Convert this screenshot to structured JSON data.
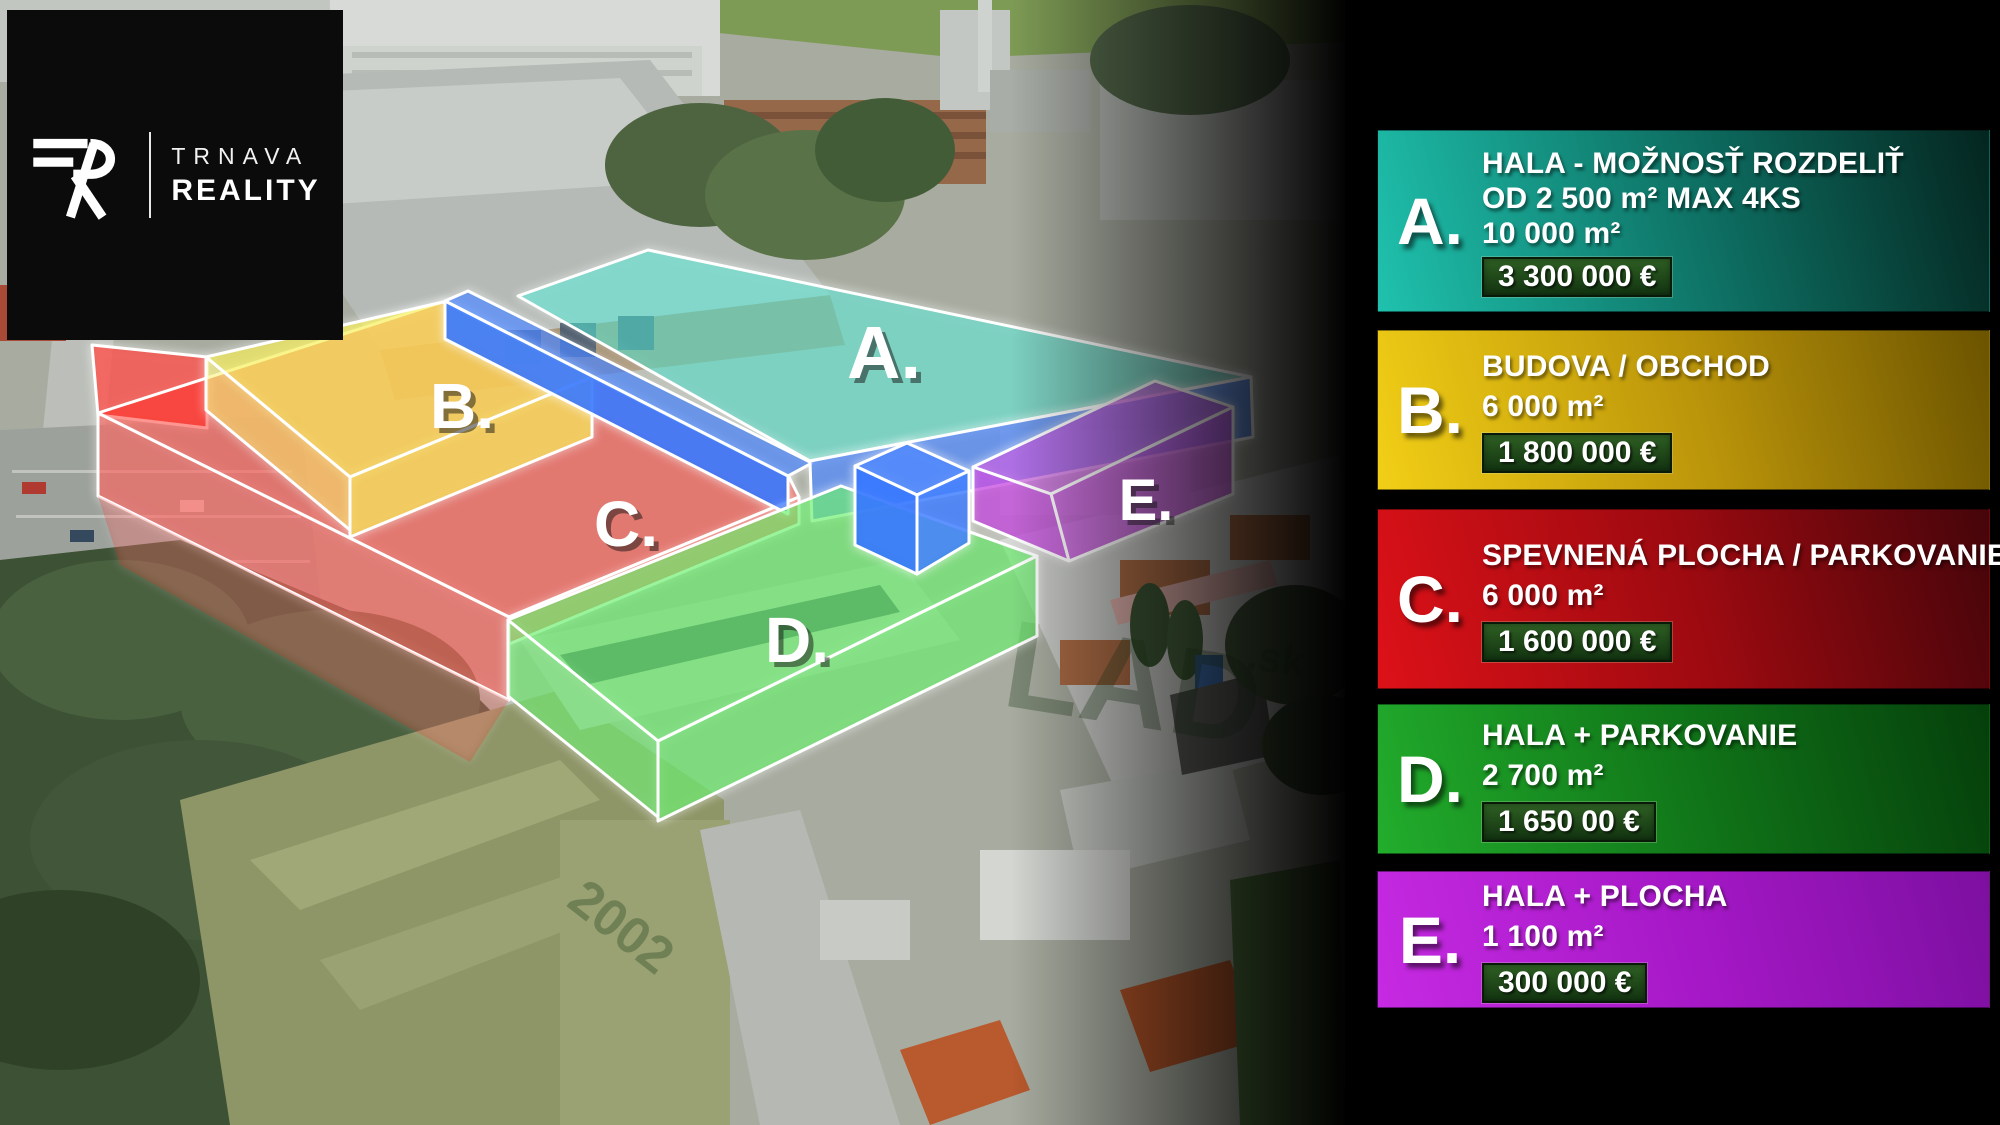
{
  "logo": {
    "monogram": "TR",
    "line1": "TRNAVA",
    "line2": "REALITY"
  },
  "map": {
    "zones": [
      {
        "id": "A",
        "label": "A.",
        "color": "#1de0c6"
      },
      {
        "id": "B",
        "label": "B.",
        "color": "#f5ea1c"
      },
      {
        "id": "C",
        "label": "C.",
        "color": "#ff211a"
      },
      {
        "id": "D",
        "label": "D.",
        "color": "#35e93a"
      },
      {
        "id": "E",
        "label": "E.",
        "color": "#b81fd8"
      }
    ],
    "accents": {
      "corridor": "#1a64ff",
      "edge_glow": "#ffffff"
    },
    "ground_markings": [
      "LAD",
      ".sk",
      "2002"
    ]
  },
  "sidebar": {
    "price_badge": {
      "bg_top": "#2e5f23",
      "bg_bottom": "#123310",
      "border": "#0a1a08"
    },
    "cards": [
      {
        "id": "A",
        "letter": "A.",
        "lines": [
          "HALA - MOŽNOSŤ ROZDELIŤ",
          "OD 2 500 m² MAX 4KS",
          "10 000 m²"
        ],
        "price": "3 300 000 €",
        "gradient": {
          "from": "#1fc2ae",
          "mid": "#0e7265",
          "to": "#04251f"
        }
      },
      {
        "id": "B",
        "letter": "B.",
        "lines": [
          "BUDOVA / OBCHOD",
          "6 000 m²"
        ],
        "price": "1 800 000 €",
        "gradient": {
          "from": "#f2cf16",
          "mid": "#bb950a",
          "to": "#6b5300"
        }
      },
      {
        "id": "C",
        "letter": "C.",
        "lines": [
          "SPEVNENÁ PLOCHA / PARKOVANIE",
          "6 000 m²"
        ],
        "price": "1 600 000 €",
        "gradient": {
          "from": "#dd1118",
          "mid": "#9c0a10",
          "to": "#45050a"
        }
      },
      {
        "id": "D",
        "letter": "D.",
        "lines": [
          "HALA + PARKOVANIE",
          "2 700 m²"
        ],
        "price": "1 650 00 €",
        "gradient": {
          "from": "#22ad2c",
          "mid": "#107418",
          "to": "#053f0b"
        }
      },
      {
        "id": "E",
        "letter": "E.",
        "lines": [
          "HALA + PLOCHA",
          "1 100 m²"
        ],
        "price": "300 000 €",
        "gradient": {
          "from": "#c62ae2",
          "mid": "#a518c6",
          "to": "#7c0fa0"
        }
      }
    ]
  }
}
